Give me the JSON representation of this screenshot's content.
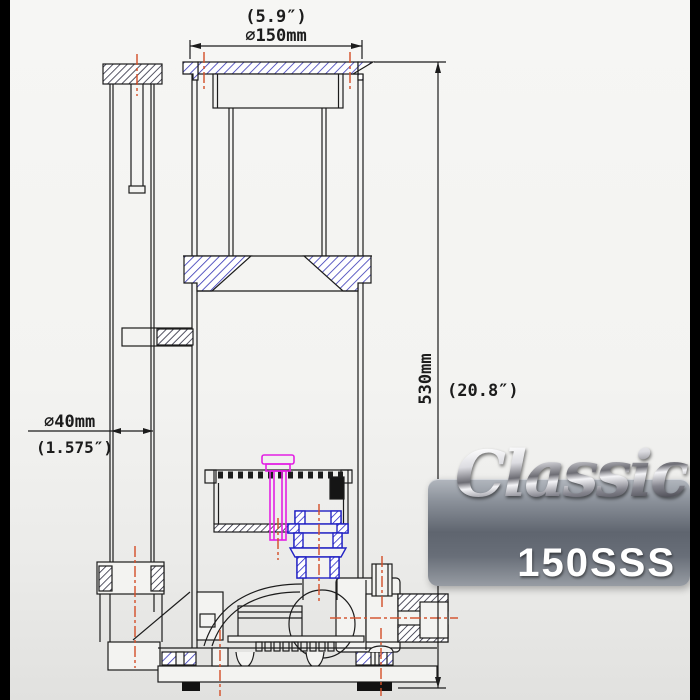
{
  "frame": {
    "side_bar_color": "#000000",
    "background_top": "#f6f6f4",
    "background_bottom": "#e1e1df"
  },
  "drawing": {
    "line_color": "#1c1c1c",
    "hatch_blue": "#3535b5",
    "hatch_dark": "#1c1c30",
    "centerline_color": "#d4502a",
    "injector_color": "#e321e3",
    "pump_union_color": "#2222c4",
    "dimensions": {
      "top_inches": "(5.9″)",
      "top_metric": "⌀150mm",
      "right_metric": "530mm",
      "right_inches": "(20.8″)",
      "left_metric": "⌀40mm",
      "left_inches": "(1.575″)"
    }
  },
  "badge": {
    "brand": "Classic",
    "model": "150SSS",
    "text_color": "#ffffff"
  }
}
